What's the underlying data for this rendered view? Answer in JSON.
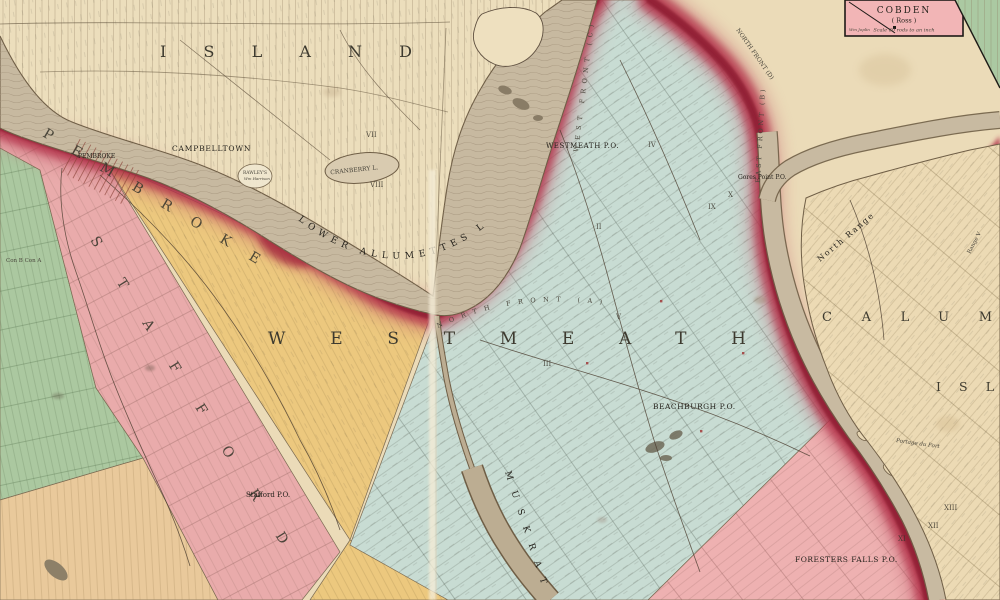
{
  "map": {
    "big_labels": {
      "island": "ISLAND",
      "pembroke": "PEMBROKE",
      "stafford": "STAFFORD",
      "westmeath": "WESTMEATH",
      "calumet": "CALUM",
      "calumet_isl": "ISL",
      "lower_allumettes": "LOWER ALLUMETTES L.",
      "muskrat": "MUSKRAT"
    },
    "places": {
      "campbelltown": "CAMPBELLTOWN",
      "pembroke_town": "PEMBROKE",
      "westmeath_po": "WESTMEATH P.O.",
      "gores_point_po": "Gores Point P.O.",
      "beachburgh_po": "BEACHBURGH P.O.",
      "stafford_po": "Stafford P.O.",
      "foresters_falls_po": "FORESTERS FALLS P.O.",
      "rawleys": "RAWLEY'S",
      "wm_harrison": "Wm Harrison",
      "cranberry_lake": "CRANBERRY L.",
      "portage": "Portage du Fort",
      "con_labels": "Con B   Con A"
    },
    "ranges": {
      "north_front_a": "NORTH FRONT (A)",
      "west_front_c": "WEST FRONT (C)",
      "east_front_b": "EAST FRONT (B)",
      "north_front_d": "NORTH FRONT (D)",
      "north_range": "North Range",
      "range_v": "Range V"
    },
    "inset_cobden": {
      "title": "COBDEN",
      "subtitle": "( Ross )",
      "scale_note": "Scale 60 rods to an inch",
      "owner": "Wm Joplin"
    },
    "numerals": [
      {
        "t": "VII"
      },
      {
        "t": "VIII"
      },
      {
        "t": "II"
      },
      {
        "t": "III"
      },
      {
        "t": "IV"
      },
      {
        "t": "V"
      },
      {
        "t": "IX"
      },
      {
        "t": "X"
      },
      {
        "t": "XI"
      },
      {
        "t": "XII"
      },
      {
        "t": "XIII"
      }
    ],
    "colors": {
      "paper": "#ebdbb8",
      "island_paper": "#ecdebc",
      "water": "#c7b9a0",
      "westmeath_teal": "#c8dcd3",
      "stafford_pink": "#e9abab",
      "ross_pink": "#eeb1b1",
      "pembroke_yellow": "#ecc87e",
      "green_township": "#abc8a0",
      "orange_township": "#e9c99b",
      "boundary_red": "#b23048",
      "boundary_red_dark": "#8e1f32",
      "inset_pink": "#f2b5b6",
      "ink": "#3a362c"
    }
  }
}
